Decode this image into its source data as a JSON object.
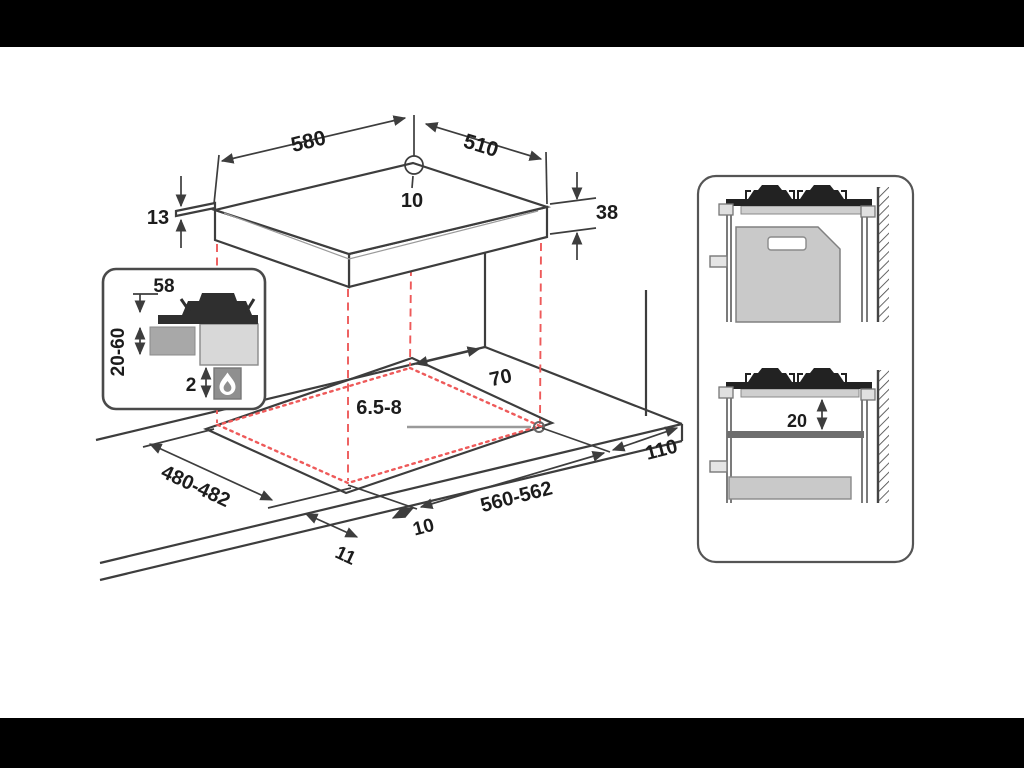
{
  "diagram": {
    "type": "gas-hob-installation-dimensions",
    "colors": {
      "background": "#000000",
      "canvas": "#ffffff",
      "line": "#3d3d3d",
      "projection_red": "#ee5a5a",
      "fill_dark": "#262626",
      "fill_mid": "#c9c9c9",
      "fill_gray": "#a8a8a8",
      "text": "#1c1c1c"
    },
    "hob": {
      "width": "580",
      "depth": "510",
      "hole_offset": "10",
      "rim_thickness": "13",
      "total_height": "38"
    },
    "detail_inset": {
      "burner_clearance": "58",
      "worktop_thickness": "20-60",
      "bottom_gap": "2"
    },
    "cutout": {
      "rear_clearance": "70",
      "fixing_hole": "6.5-8",
      "depth_range": "480-482",
      "width_range": "560-562",
      "side_clearance": "110",
      "front_overhang": "10",
      "side_overhang": "11"
    },
    "cabinet_view": {
      "shelf_gap": "20"
    }
  }
}
